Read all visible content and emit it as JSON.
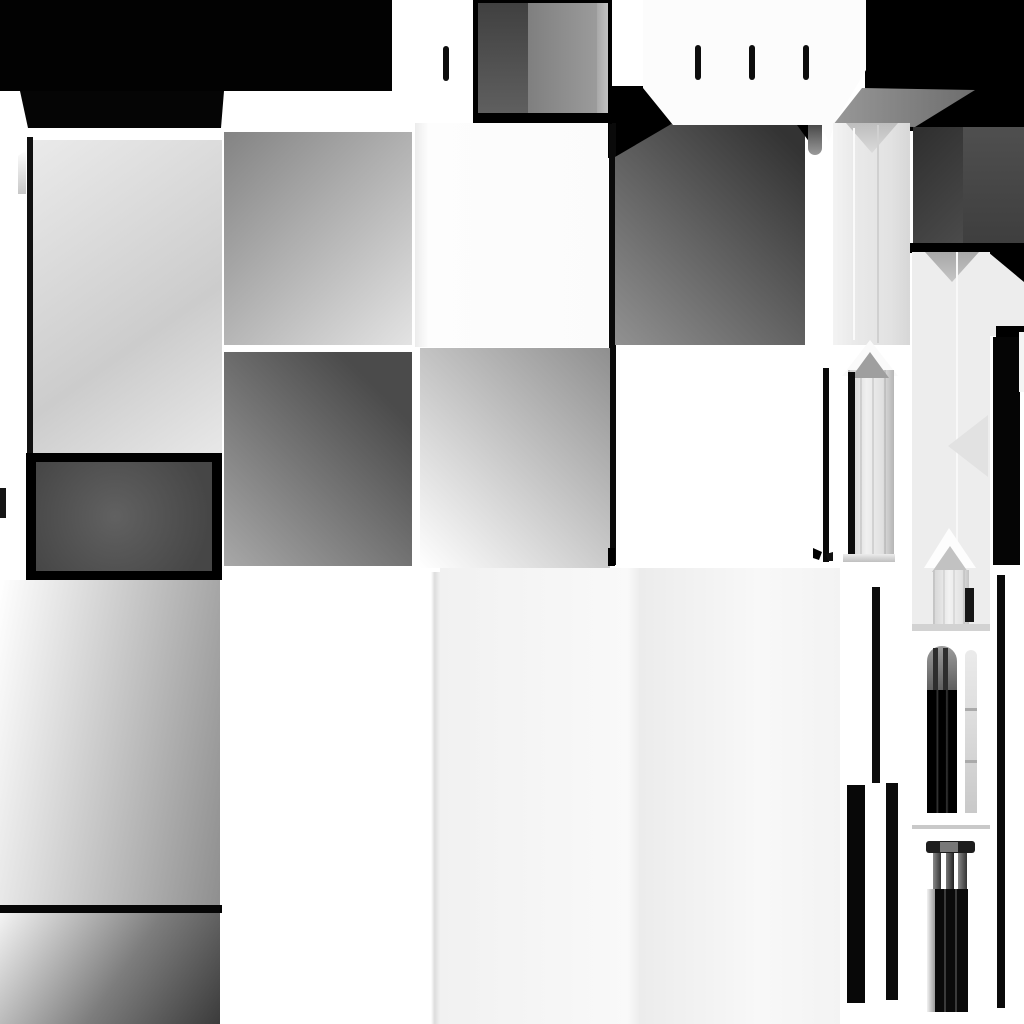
{
  "meta": {
    "kind": "grayscale-texture-atlas",
    "canvas_width": 1024,
    "canvas_height": 1024,
    "background": "#ffffff",
    "palette": {
      "black": "#000000",
      "dark_gray": "#3a3a3a",
      "mid_gray": "#8a8a8a",
      "light_gray": "#ededed",
      "white": "#ffffff"
    }
  },
  "tiles": [
    {
      "name": "top-black-band",
      "x": 0,
      "y": 0,
      "w": 392,
      "h": 91,
      "fill": "#020202"
    },
    {
      "name": "top-black-hood",
      "x": 20,
      "y": 91,
      "w": 204,
      "h": 37,
      "fill": "#050505",
      "clip": "polygon(0px 0px,204px 0px,201px 37px,8px 37px)"
    },
    {
      "name": "top-right-black-field",
      "x": 865,
      "y": 0,
      "w": 159,
      "h": 131,
      "fill": "#000000"
    },
    {
      "name": "center-black-corner",
      "x": 604,
      "y": 86,
      "w": 72,
      "h": 72,
      "fill": "#000000"
    },
    {
      "name": "center-black-line",
      "x": 609,
      "y": 123,
      "w": 7,
      "h": 442,
      "fill": "#0a0a0a"
    },
    {
      "name": "graybox-frame",
      "x": 473,
      "y": 0,
      "w": 139,
      "h": 124,
      "fill": "#000000"
    },
    {
      "name": "graybox-left-face",
      "x": 478,
      "y": 3,
      "w": 50,
      "h": 110,
      "fill": "linear-gradient(180deg,#404040,#5f5f5f)"
    },
    {
      "name": "graybox-right-face",
      "x": 528,
      "y": 3,
      "w": 69,
      "h": 110,
      "fill": "linear-gradient(90deg,#7f7f7f,#9b9b9b)"
    },
    {
      "name": "graybox-bevel",
      "x": 597,
      "y": 3,
      "w": 11,
      "h": 110,
      "fill": "linear-gradient(90deg,#a8a8a8,#c2c2c2)"
    },
    {
      "name": "panel-a",
      "x": 33,
      "y": 140,
      "w": 189,
      "h": 315,
      "fill": "linear-gradient(145deg,#eaeaea,#cccccc 62%,#e8e8e8)"
    },
    {
      "name": "left-frame-line",
      "x": 27,
      "y": 137,
      "w": 6,
      "h": 441,
      "fill": "#101010"
    },
    {
      "name": "left-sliver",
      "x": 18,
      "y": 150,
      "w": 8,
      "h": 44,
      "fill": "linear-gradient(180deg,#ffffff,#c7c7c7)",
      "clip": "polygon(0px 6px,8px 0px,8px 44px,0px 44px)"
    },
    {
      "name": "left-edge-bar",
      "x": 0,
      "y": 488,
      "w": 6,
      "h": 30,
      "fill": "#151515"
    },
    {
      "name": "framed-box-border",
      "x": 26,
      "y": 453,
      "w": 196,
      "h": 127,
      "fill": "#000000"
    },
    {
      "name": "framed-box-inner",
      "x": 36,
      "y": 462,
      "w": 176,
      "h": 109,
      "fill": "radial-gradient(circle at 45% 50%,#616161,#464646 85%)"
    },
    {
      "name": "panel-c",
      "x": 0,
      "y": 580,
      "w": 220,
      "h": 325,
      "fill": "linear-gradient(100deg,#ffffff,#8f8f8f)"
    },
    {
      "name": "panel-divider-line",
      "x": 0,
      "y": 905,
      "w": 222,
      "h": 8,
      "fill": "#060606"
    },
    {
      "name": "panel-d",
      "x": 0,
      "y": 913,
      "w": 220,
      "h": 111,
      "fill": "linear-gradient(125deg,#f4f4f4,#7d7d7d 55%,#3b3b3b)"
    },
    {
      "name": "panel-e",
      "x": 224,
      "y": 132,
      "w": 188,
      "h": 213,
      "fill": "linear-gradient(135deg,#838383,#e3e3e3)"
    },
    {
      "name": "panel-f",
      "x": 224,
      "y": 352,
      "w": 188,
      "h": 214,
      "fill": "linear-gradient(225deg,#4b4b4b 18%,#a8a8a8)"
    },
    {
      "name": "panel-g",
      "x": 415,
      "y": 123,
      "w": 193,
      "h": 224,
      "fill": "linear-gradient(90deg,#ececec,#fdfdfd 7%,#fbfbfb)"
    },
    {
      "name": "panel-h",
      "x": 420,
      "y": 348,
      "w": 190,
      "h": 220,
      "fill": "linear-gradient(45deg,#ffffff,#8f8f8f)"
    },
    {
      "name": "panel-i",
      "x": 615,
      "y": 123,
      "w": 190,
      "h": 222,
      "fill": "linear-gradient(225deg,#333333 8%,#919191)",
      "clip": "polygon(58px 0px,190px 0px,190px 222px,0px 222px,0px 34px)"
    },
    {
      "name": "panel-i-corner-notch",
      "x": 797,
      "y": 125,
      "w": 13,
      "h": 18,
      "fill": "#000000",
      "clip": "polygon(0px 0px,13px 0px,13px 18px)"
    },
    {
      "name": "octagon-plate",
      "x": 643,
      "y": 0,
      "w": 223,
      "h": 142,
      "fill": "#fcfcfc",
      "clip": "polygon(0px 0px,223px 0px,223px 70px,192px 122px,186px 142px,179px 128px,168px 125px,30px 125px,0px 88px)"
    },
    {
      "name": "tick-1",
      "x": 695,
      "y": 45,
      "w": 6,
      "h": 35,
      "fill": "#0d0d0d",
      "radius": "3px"
    },
    {
      "name": "tick-2",
      "x": 749,
      "y": 45,
      "w": 6,
      "h": 35,
      "fill": "#0d0d0d",
      "radius": "3px"
    },
    {
      "name": "tick-3",
      "x": 803,
      "y": 45,
      "w": 6,
      "h": 35,
      "fill": "#0d0d0d",
      "radius": "3px"
    },
    {
      "name": "tick-4",
      "x": 443,
      "y": 46,
      "w": 6,
      "h": 35,
      "fill": "#0d0d0d",
      "radius": "3px"
    },
    {
      "name": "roof-bevel",
      "x": 833,
      "y": 86,
      "w": 142,
      "h": 41,
      "fill": "linear-gradient(90deg,#989898,#6d6d6d)",
      "clip": "polygon(29px 2px,142px 4px,82px 41px,0px 39px)"
    },
    {
      "name": "gray-tab",
      "x": 808,
      "y": 125,
      "w": 14,
      "h": 30,
      "fill": "linear-gradient(180deg,#4a4a4a,#9a9a9a)",
      "radius": "0 0 7px 7px"
    },
    {
      "name": "column1",
      "x": 833,
      "y": 123,
      "w": 77,
      "h": 222,
      "fill": "linear-gradient(90deg,#f3f3f3,#e9e9e9 30%,#e2e2e2 75%,#d7d7d7)"
    },
    {
      "name": "column1-v-notch",
      "x": 846,
      "y": 123,
      "w": 52,
      "h": 30,
      "fill": "linear-gradient(180deg,#bdbdbd,#dadada)",
      "clip": "polygon(0px 0px,52px 0px,26px 30px)"
    },
    {
      "name": "column1-seam-left",
      "x": 853,
      "y": 128,
      "w": 2,
      "h": 212,
      "fill": "#fafafa"
    },
    {
      "name": "column1-seam-right",
      "x": 877,
      "y": 125,
      "w": 2,
      "h": 218,
      "fill": "#d0d0d0"
    },
    {
      "name": "darkbox-left-face",
      "x": 913,
      "y": 127,
      "w": 50,
      "h": 118,
      "fill": "linear-gradient(135deg,#2e2e2e,#4b4b4b)"
    },
    {
      "name": "darkbox-right-face",
      "x": 963,
      "y": 127,
      "w": 61,
      "h": 118,
      "fill": "linear-gradient(180deg,#4f4f4f,#3e3e3e)"
    },
    {
      "name": "darkbox-bottom-band",
      "x": 910,
      "y": 243,
      "w": 114,
      "h": 10,
      "fill": "#000000"
    },
    {
      "name": "chamfer-black",
      "x": 988,
      "y": 250,
      "w": 36,
      "h": 36,
      "fill": "#000000"
    },
    {
      "name": "chamfer-white",
      "x": 988,
      "y": 252,
      "w": 36,
      "h": 34,
      "fill": "#ededed",
      "clip": "polygon(0px 0px,36px 30px,36px 34px,0px 34px)"
    },
    {
      "name": "column2-right-ext",
      "x": 988,
      "y": 286,
      "w": 36,
      "h": 50,
      "fill": "#ededed"
    },
    {
      "name": "column2-notch-black",
      "x": 996,
      "y": 326,
      "w": 28,
      "h": 34,
      "fill": "#000000"
    },
    {
      "name": "column2",
      "x": 912,
      "y": 252,
      "w": 78,
      "h": 310,
      "fill": "#ededed"
    },
    {
      "name": "column2-v-notch",
      "x": 925,
      "y": 252,
      "w": 54,
      "h": 30,
      "fill": "linear-gradient(180deg,#a8a8a8,#c5c5c5)",
      "clip": "polygon(0px 0px,54px 0px,27px 30px)"
    },
    {
      "name": "column2-seam",
      "x": 956,
      "y": 252,
      "w": 2,
      "h": 310,
      "fill": "#f8f8f8"
    },
    {
      "name": "column2-chevron",
      "x": 948,
      "y": 415,
      "w": 40,
      "h": 62,
      "fill": "#e2e2e2",
      "clip": "polygon(0px 31px,40px 0px,40px 62px)"
    },
    {
      "name": "right-black-strip",
      "x": 993,
      "y": 337,
      "w": 27,
      "h": 228,
      "fill": "#050505"
    },
    {
      "name": "right-white-sliver",
      "x": 1019,
      "y": 332,
      "w": 5,
      "h": 60,
      "fill": "#f4f4f4"
    },
    {
      "name": "column2-lower",
      "x": 912,
      "y": 560,
      "w": 78,
      "h": 70,
      "fill": "#ededed"
    },
    {
      "name": "window1-arch-outer",
      "x": 842,
      "y": 340,
      "w": 56,
      "h": 36,
      "fill": "#fafafa",
      "clip": "polygon(28px 0px,56px 36px,0px 36px)"
    },
    {
      "name": "window1-recess",
      "x": 848,
      "y": 370,
      "w": 46,
      "h": 188,
      "fill": "repeating-linear-gradient(90deg, rgba(0,0,0,0.10) 0 2px, rgba(0,0,0,0) 2px 12px), linear-gradient(90deg,#cdcdcd,#f0f0f0 40%,#e0e0e0 75%,#b5b5b5)"
    },
    {
      "name": "window1-arch-inner",
      "x": 851,
      "y": 352,
      "w": 38,
      "h": 26,
      "fill": "#9f9f9f",
      "clip": "polygon(19px 0px,38px 26px,0px 26px)"
    },
    {
      "name": "window1-black-line",
      "x": 848,
      "y": 372,
      "w": 7,
      "h": 186,
      "fill": "#0b0b0b"
    },
    {
      "name": "window1-base",
      "x": 843,
      "y": 554,
      "w": 52,
      "h": 8,
      "fill": "linear-gradient(180deg,#ececec,#bfbfbf)"
    },
    {
      "name": "window1-left-black-strip",
      "x": 823,
      "y": 368,
      "w": 6,
      "h": 194,
      "fill": "#0a0a0a"
    },
    {
      "name": "window2-arch-outer",
      "x": 924,
      "y": 528,
      "w": 52,
      "h": 40,
      "fill": "#fdfdfd",
      "clip": "polygon(25px 0px,52px 40px,0px 40px)"
    },
    {
      "name": "window2-arch-inner",
      "x": 932,
      "y": 546,
      "w": 36,
      "h": 26,
      "fill": "#c2c2c2",
      "clip": "polygon(18px 0px,36px 26px,0px 26px)"
    },
    {
      "name": "window2-recess",
      "x": 933,
      "y": 570,
      "w": 36,
      "h": 56,
      "fill": "repeating-linear-gradient(90deg, rgba(0,0,0,0.08) 0 2px, rgba(0,0,0,0) 2px 10px), linear-gradient(90deg,#d5d5d5,#f2f2f2 45%,#e2e2e2 80%,#c4c4c4)"
    },
    {
      "name": "window2-dark-rect",
      "x": 965,
      "y": 588,
      "w": 9,
      "h": 34,
      "fill": "#161616"
    },
    {
      "name": "window2-base",
      "x": 912,
      "y": 624,
      "w": 78,
      "h": 7,
      "fill": "#d2d2d2"
    },
    {
      "name": "capital-separator",
      "x": 912,
      "y": 825,
      "w": 78,
      "h": 4,
      "fill": "#c9c9c9"
    },
    {
      "name": "capital1-cap",
      "x": 927,
      "y": 646,
      "w": 30,
      "h": 44,
      "fill": "linear-gradient(180deg,#9b9b9b,#5f5f5f)",
      "radius": "15px 15px 0 0"
    },
    {
      "name": "capital1-cap-stripe1",
      "x": 933,
      "y": 648,
      "w": 5,
      "h": 42,
      "fill": "#2d2d2d"
    },
    {
      "name": "capital1-cap-stripe2",
      "x": 943,
      "y": 648,
      "w": 5,
      "h": 42,
      "fill": "#2d2d2d"
    },
    {
      "name": "capital1-body",
      "x": 927,
      "y": 690,
      "w": 30,
      "h": 123,
      "fill": "linear-gradient(90deg,#000000 30%,#3a3a3a 34%,#000000 40%,#000000 62%,#3a3a3a 66%,#000000 72%)"
    },
    {
      "name": "capital1-light-column",
      "x": 965,
      "y": 650,
      "w": 12,
      "h": 163,
      "fill": "linear-gradient(180deg,#ebebeb,#c9c9c9)",
      "radius": "6px 6px 0 0"
    },
    {
      "name": "capital1-column-seg1",
      "x": 965,
      "y": 708,
      "w": 12,
      "h": 3,
      "fill": "#aaaaaa"
    },
    {
      "name": "capital1-column-seg2",
      "x": 965,
      "y": 760,
      "w": 12,
      "h": 3,
      "fill": "#aaaaaa"
    },
    {
      "name": "capital2-top-bar",
      "x": 926,
      "y": 841,
      "w": 49,
      "h": 12,
      "fill": "#1d1d1d",
      "radius": "3px"
    },
    {
      "name": "capital2-bar-mid",
      "x": 940,
      "y": 842,
      "w": 18,
      "h": 10,
      "fill": "#787878"
    },
    {
      "name": "capital2-post1",
      "x": 933,
      "y": 853,
      "w": 8,
      "h": 36,
      "fill": "linear-gradient(90deg,#888888,#333333)"
    },
    {
      "name": "capital2-post2",
      "x": 946,
      "y": 853,
      "w": 8,
      "h": 36,
      "fill": "linear-gradient(90deg,#777777,#222222)"
    },
    {
      "name": "capital2-post3",
      "x": 958,
      "y": 853,
      "w": 9,
      "h": 36,
      "fill": "linear-gradient(90deg,#888888,#333333)"
    },
    {
      "name": "capital2-body",
      "x": 927,
      "y": 889,
      "w": 41,
      "h": 123,
      "fill": "#0a0a0a"
    },
    {
      "name": "capital2-left-strip",
      "x": 927,
      "y": 889,
      "w": 8,
      "h": 123,
      "fill": "linear-gradient(90deg,#f2f2f2,#9a9a9a)"
    },
    {
      "name": "capital2-seam1",
      "x": 944,
      "y": 889,
      "w": 2,
      "h": 123,
      "fill": "#3a3a3a"
    },
    {
      "name": "capital2-seam2",
      "x": 955,
      "y": 889,
      "w": 2,
      "h": 123,
      "fill": "#3a3a3a"
    },
    {
      "name": "thin-bar",
      "x": 872,
      "y": 587,
      "w": 8,
      "h": 196,
      "fill": "#0c0c0c"
    },
    {
      "name": "bottom-bar-left",
      "x": 847,
      "y": 785,
      "w": 18,
      "h": 218,
      "fill": "#080808"
    },
    {
      "name": "bottom-bar-right",
      "x": 886,
      "y": 783,
      "w": 12,
      "h": 217,
      "fill": "#0b0b0b"
    },
    {
      "name": "right-long-line",
      "x": 997,
      "y": 575,
      "w": 8,
      "h": 433,
      "fill": "#0a0a0a"
    },
    {
      "name": "big-light-panel-edge",
      "x": 431,
      "y": 572,
      "w": 9,
      "h": 452,
      "fill": "linear-gradient(90deg,#ffffff,#dddddd 40%,#f1f1f1)"
    },
    {
      "name": "big-light-panel",
      "x": 440,
      "y": 568,
      "w": 400,
      "h": 456,
      "fill": "linear-gradient(90deg,#f1f1f1,#f9f9f9 47%,#ececec 50%,#f8f8f8 80%,#f3f3f3)"
    },
    {
      "name": "mark-center",
      "x": 608,
      "y": 548,
      "w": 7,
      "h": 18,
      "fill": "#000000"
    },
    {
      "name": "mark-right-a",
      "x": 813,
      "y": 548,
      "w": 9,
      "h": 12,
      "fill": "#000000",
      "clip": "polygon(0px 0px,9px 4px,6px 12px,0px 10px)"
    },
    {
      "name": "mark-right-b",
      "x": 826,
      "y": 552,
      "w": 7,
      "h": 9,
      "fill": "#111111",
      "clip": "polygon(0px 2px,7px 0px,7px 9px,2px 9px)"
    }
  ]
}
